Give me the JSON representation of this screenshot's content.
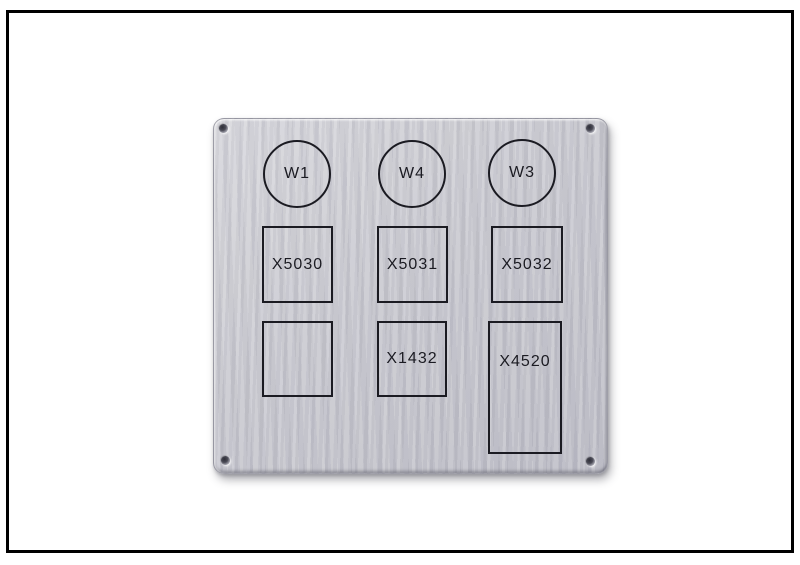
{
  "plate": {
    "circles": [
      {
        "label": "W1"
      },
      {
        "label": "W4"
      },
      {
        "label": "W3"
      }
    ],
    "rects_row1": [
      {
        "label": "X5030"
      },
      {
        "label": "X5031"
      },
      {
        "label": "X5032"
      }
    ],
    "rects_row2": [
      {
        "label": ""
      },
      {
        "label": "X1432"
      },
      {
        "label": "X4520"
      }
    ]
  },
  "colors": {
    "canvas_background": "#ffffff",
    "frame_border": "#000000",
    "plate_light": "#d6d6db",
    "plate_base": "#c8c8cf",
    "plate_dark": "#bdbdc6",
    "engraving_stroke": "#1b1b22",
    "label_text": "#1b1b22"
  }
}
